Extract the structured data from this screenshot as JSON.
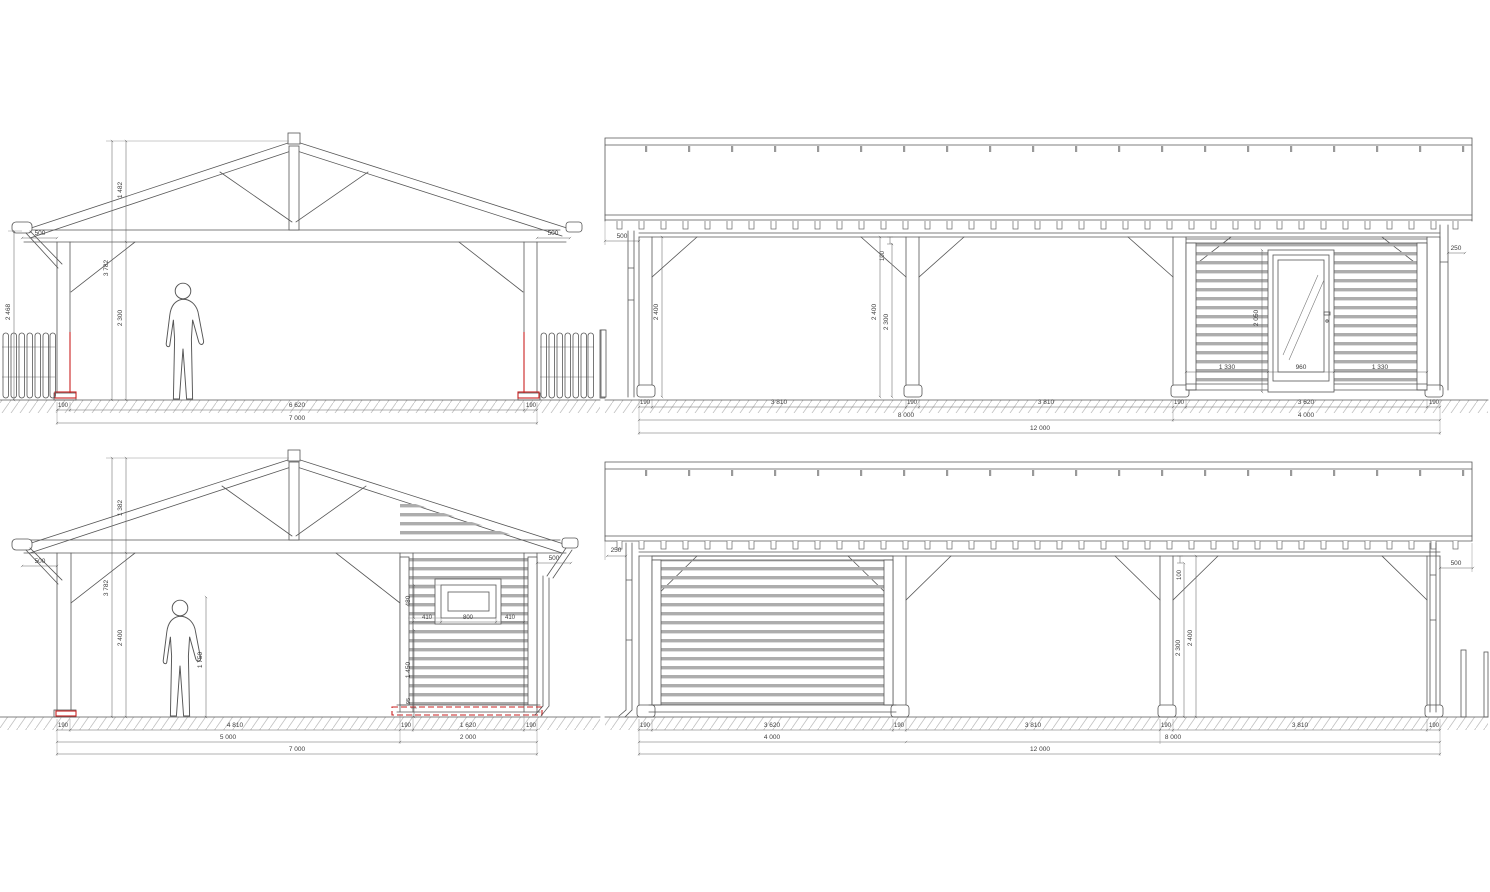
{
  "drawing": {
    "accent_red": "#c92121",
    "line_color": "#565656",
    "slat_gray": "#adadad",
    "hatch_gray": "#c2c2c2"
  },
  "views": {
    "top_left": {
      "dims": {
        "outer_height": "2 468",
        "overhang_left": "500",
        "ridge_rise": "1 482",
        "eave_height": "3 782",
        "clear_height": "2 300",
        "overhang_right": "500",
        "post_left": "190",
        "clear_span": "6 620",
        "post_right": "190",
        "total_span": "7 000"
      }
    },
    "top_right": {
      "dims": {
        "overhang_left": "500",
        "post1_height": "2 400",
        "brace_drop": "100",
        "post2_height": "2 400",
        "post2_clear": "2 300",
        "door_height": "2 050",
        "wall_left": "1 330",
        "door_width": "960",
        "wall_right": "1 330",
        "downpipe_offset": "250",
        "post1": "190",
        "bay1": "3 810",
        "post2": "190",
        "bay2": "3 810",
        "post3": "190",
        "bay3": "3 620",
        "post4": "190",
        "carport_length": "8 000",
        "store_length": "4 000",
        "total_length": "12 000"
      }
    },
    "bottom_left": {
      "dims": {
        "overhang_left": "500",
        "ridge_rise": "1 382",
        "eave_height": "3 782",
        "clear_height": "2 400",
        "person_height": "1 750",
        "overhang_right": "500",
        "window_height": "480",
        "window_left": "410",
        "window_width": "800",
        "window_right": "410",
        "sill_height": "1 450",
        "plinth_height": "95",
        "post_left": "190",
        "bay_open": "4 810",
        "post_mid": "190",
        "bay_store": "1 620",
        "post_right": "190",
        "carport_span": "5 000",
        "store_span": "2 000",
        "total_span": "7 000"
      }
    },
    "bottom_right": {
      "dims": {
        "downpipe_offset": "250",
        "brace_drop": "100",
        "post_clear": "2 300",
        "post_height": "2 400",
        "overhang_right": "500",
        "post1": "190",
        "bay1": "3 620",
        "post2": "190",
        "bay2": "3 810",
        "post3": "190",
        "bay3": "3 810",
        "post4": "190",
        "store_length": "4 000",
        "carport_length": "8 000",
        "total_length": "12 000"
      }
    }
  }
}
